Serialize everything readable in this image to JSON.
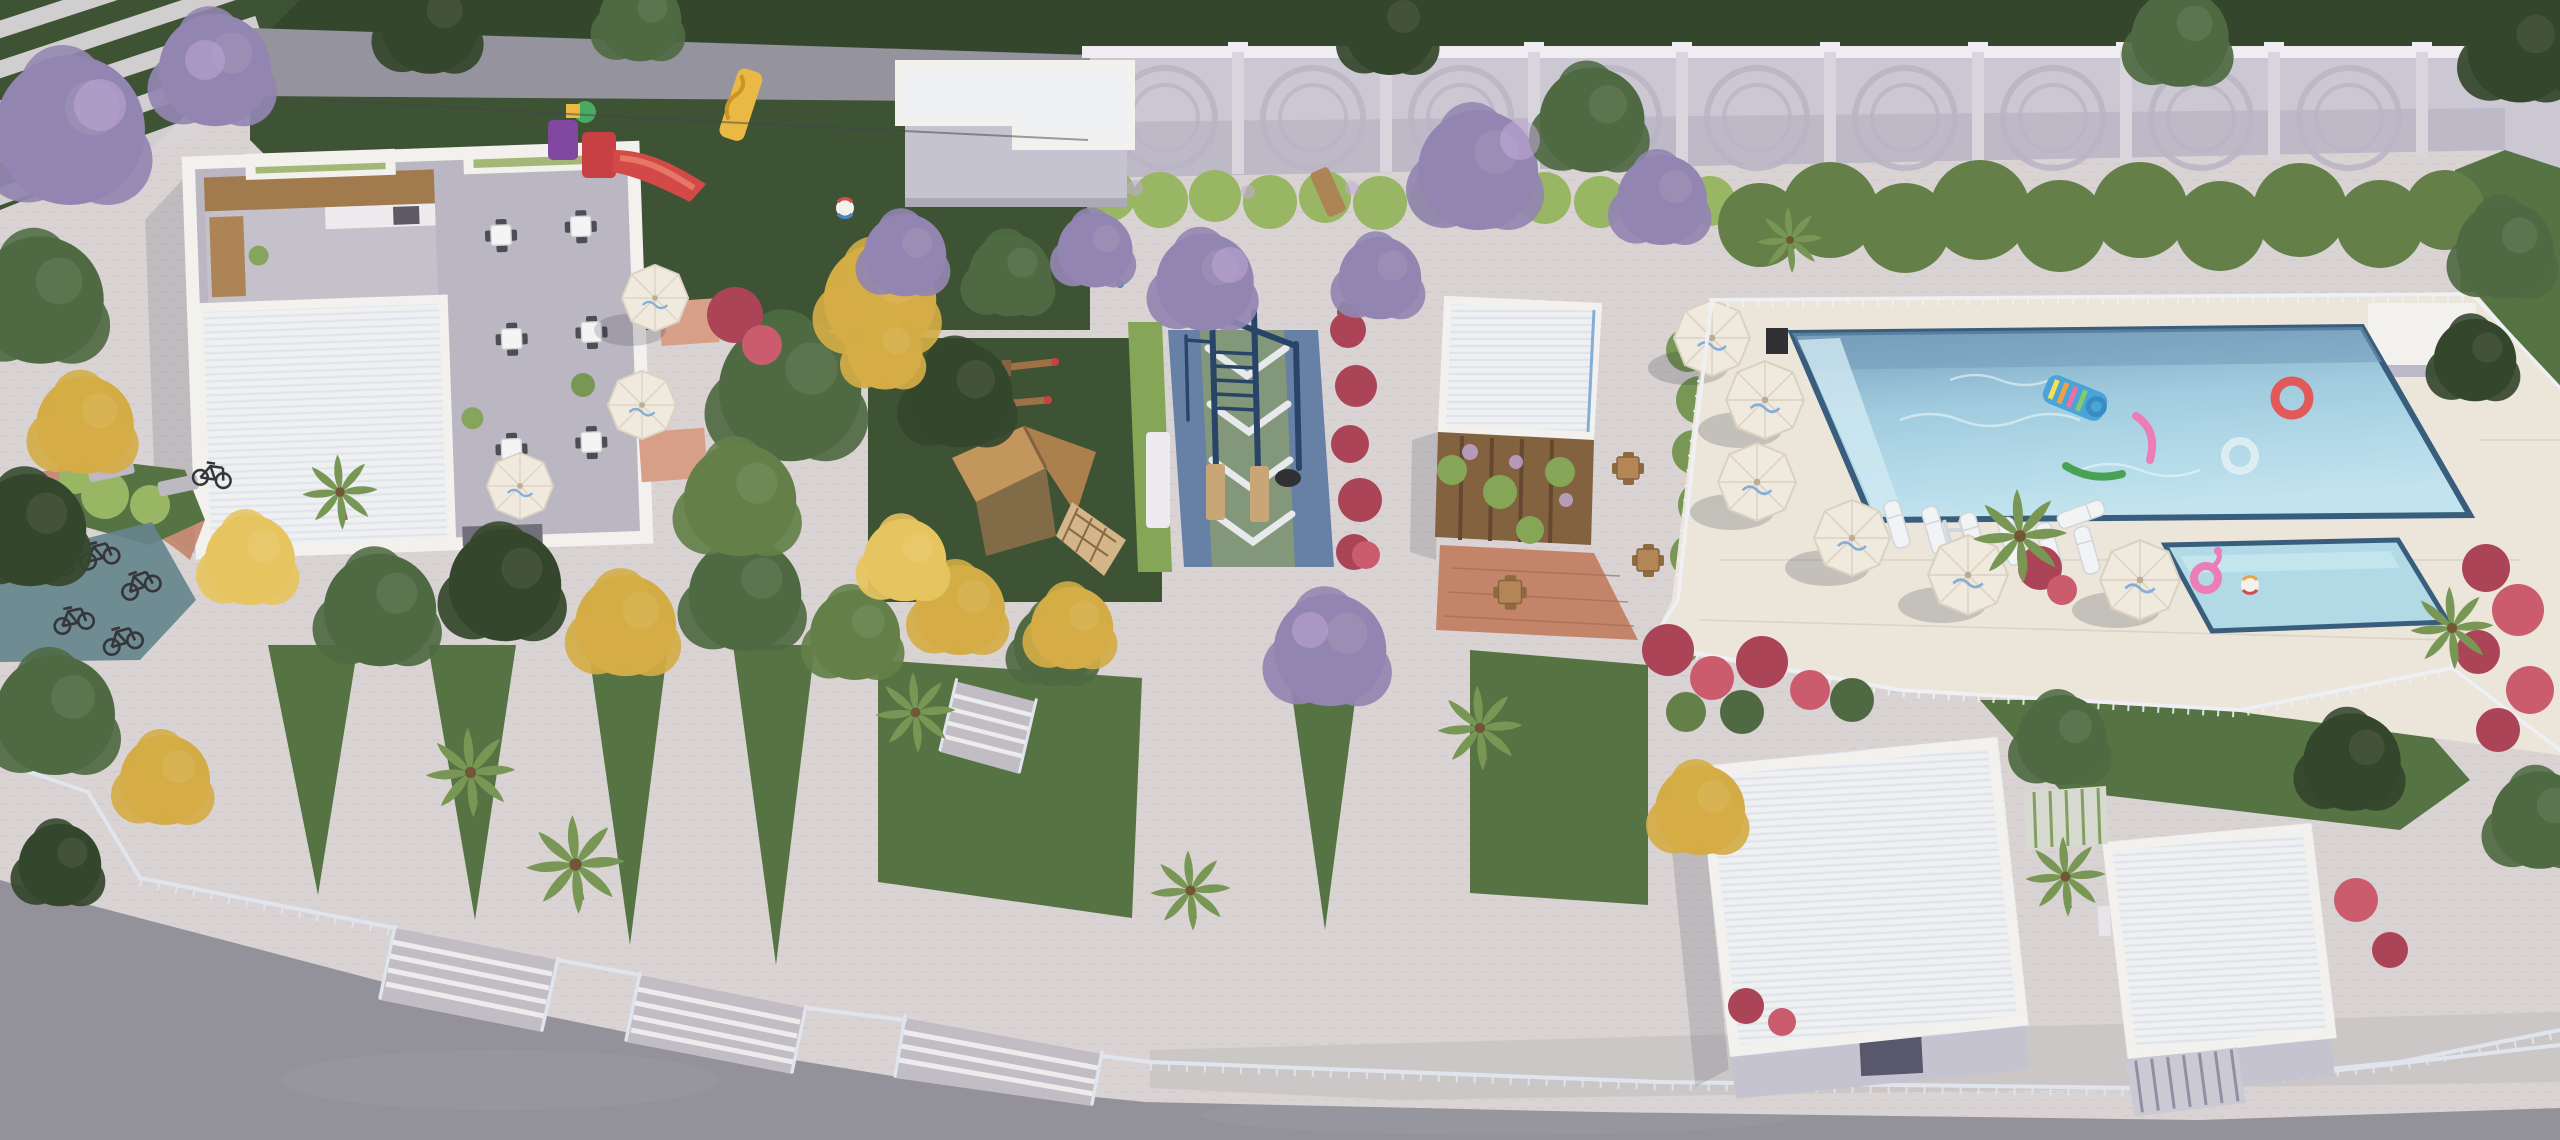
{
  "scene": {
    "type": "aerial-3d-architectural-render",
    "setting": "condominium leisure and amenity area, oblique top-down view, daylight",
    "amenities": [
      {
        "name": "clubhouse-party-hall",
        "details": "white open-air building, kitchen counter, six dining table sets, planters, partial white ribbed roof"
      },
      {
        "name": "dining-terrace",
        "details": "three beige umbrellas with tables, salmon tile accents"
      },
      {
        "name": "kids-playground",
        "details": "dark lawn with red-purple plastic castle slide, yellow wave slide, beach ball, wooden bench"
      },
      {
        "name": "bike-parking",
        "details": "six bicycles on teal mat, terracotta path band, planter, concrete benches"
      },
      {
        "name": "calisthenics-court",
        "details": "blue rubber floor, green chevron strip, navy pull-up rig, wood platforms, tire, white storage bench"
      },
      {
        "name": "wooden-playset-lawn",
        "details": "two timber seesaws and gabled playhouse with climbing net"
      },
      {
        "name": "pergola-grill-building",
        "details": "white ribbed roof with blue trim, timber trellis with flowering vines, terracotta patio with wood dining sets"
      },
      {
        "name": "main-pool",
        "details": "rectangular pool, navy waterline tile, corner steps, ladder, lifeguard chair"
      },
      {
        "name": "kids-pool",
        "details": "small rectangular pool with flamingo ring and beach ball"
      },
      {
        "name": "pool-deck",
        "details": "cream paving, white perimeter fence, six white umbrellas, seven sun loungers, palms"
      },
      {
        "name": "esplanade",
        "details": "paved plaza with triangular grass wedges, palms, staircases with railings down to street"
      },
      {
        "name": "service-buildings",
        "details": "two white ribbed-roof utility buildings with louver gates, bottom right"
      },
      {
        "name": "utility-building-north",
        "details": "white flat-roof volume attached to perimeter wall"
      },
      {
        "name": "perimeter-wall",
        "details": "light masonry wall with embossed concentric-circle motifs, pilasters and white coping"
      },
      {
        "name": "street",
        "details": "asphalt road along bottom edge with concrete sidewalk and metal railings"
      }
    ],
    "pool_floats": [
      "rainbow-mattress",
      "pink-noodle",
      "green-noodle",
      "red-ring",
      "white-ring",
      "flamingo-ring",
      "beach-ball"
    ],
    "counts": {
      "pool_umbrellas": 6,
      "terrace_umbrellas": 3,
      "sun_loungers": 9,
      "bicycles": 6,
      "wall_circle_motifs": 9,
      "staircases": 4,
      "grass_wedges": 5,
      "seesaws": 2
    },
    "vegetation": [
      "purple-flowering-trees",
      "yellow-flowering-trees",
      "green-trees",
      "palm-trees",
      "red-bougainvillea-bushes",
      "fern-hedge",
      "lawns"
    ]
  },
  "colors": {
    "paving_light": "#d7d1d3",
    "paving_shade": "#bfb9c2",
    "deck_cream": "#eae4da",
    "deck_shade": "#d9d2c6",
    "road_asphalt": "#8e8c96",
    "sidewalk": "#c9c4c6",
    "grass_dark": "#344a2b",
    "grass_mid": "#4d6c3a",
    "grass_light": "#6d8f4c",
    "tree_dark": "#2a3d22",
    "tree_green": "#46633a",
    "tree_light": "#71924c",
    "tree_olive": "#5c7a40",
    "tree_yellow": "#d2a83e",
    "tree_yellow2": "#e5c25a",
    "tree_purple": "#8d7fae",
    "flower_purple": "#c0a6d8",
    "bush_red": "#a83a50",
    "bush_red2": "#c85468",
    "hedge_green": "#7fa24e",
    "fern_green": "#93b35c",
    "wall_face": "#c9c5d2",
    "wall_shade": "#b2adbe",
    "wall_coping": "#efedf2",
    "wall_ring": "#b7b2c3",
    "brick_wall": "#908e9a",
    "building_white": "#f2f1ee",
    "building_shade": "#c2c0cf",
    "roof_white": "#eef0f3",
    "roof_rib": "#dde0e8",
    "roof_blue_edge": "#7fa9d9",
    "interior_floor": "#b7b3c0",
    "wood": "#a97e4e",
    "wood_dark": "#7c5a36",
    "counter_wood": "#9c7446",
    "terracotta": "#c07e64",
    "salmon": "#d69a83",
    "court_blue": "#5e7aa3",
    "court_green": "#7d9374",
    "court_line": "#e7e8ec",
    "rig_navy": "#1d3a60",
    "pool_border": "#2f5578",
    "pool_deep": "#6e97b8",
    "pool_mid": "#9ccadf",
    "pool_light": "#bfe3ef",
    "kids_water": "#add9e6",
    "umbrella": "#efe9dd",
    "umbrella_beige": "#e4d9c2",
    "umbrella_edge": "#d8cfbf",
    "fence_white": "#eef0f6",
    "railing": "#dfe3ee",
    "metal_dark": "#2c2c34",
    "float_pink": "#ec77b5",
    "float_red": "#e05252",
    "float_green": "#3f9e4d",
    "float_blue": "#3fa0d8",
    "mat_teal": "#5e7f88",
    "shadow": "#1c2430"
  }
}
